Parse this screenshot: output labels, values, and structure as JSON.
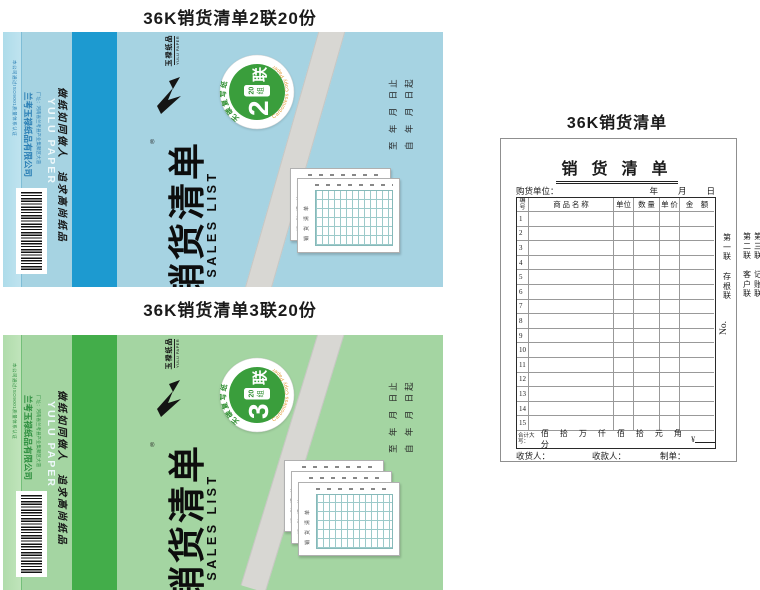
{
  "captions": {
    "blue": "36K销货清单2联20份",
    "green": "36K销货清单3联20份",
    "form": "36K销货清单"
  },
  "shared": {
    "title_cn": "销货清单",
    "title_en": "SALES LIST",
    "brand_cn": "玉禄纸品",
    "brand_en": "YULU PAPER",
    "company": "兰考玉禄纸品有限公司",
    "address": "厂址：河南省兰考县产业集聚区大道",
    "cert_line": "本公司通过ISO9001质量体系认证",
    "slogan": "做纸如同做人　追求高尚纸品",
    "date_from": "自 年 月 日起",
    "date_to": "至 年 月 日止",
    "registered": "®",
    "ring_cn": "无碳复写纸",
    "ring_en": "Carbonless Copy Paper",
    "badge_green": "#3a9e3c"
  },
  "covers": {
    "blue": {
      "product_code": "货号:36XH01",
      "badge": {
        "number": "2",
        "per": "20",
        "unit": "组",
        "lian": "联"
      },
      "bg": "#a6d3e2",
      "strip": "#1d9ad0",
      "mini_sheets": 2
    },
    "green": {
      "product_code": "货号:36XH02",
      "badge": {
        "number": "3",
        "per": "20",
        "unit": "组",
        "lian": "联"
      },
      "bg": "#a4d5a2",
      "strip": "#43ad4a",
      "mini_sheets": 3
    }
  },
  "form": {
    "title": "销 货 清 单",
    "buyer_label": "购货单位：",
    "date_line": "年　　月　　日",
    "columns": [
      "编号",
      "商 品 名 称",
      "单位",
      "数 量",
      "单 价",
      "金　额"
    ],
    "rows": [
      "1",
      "2",
      "3",
      "4",
      "5",
      "6",
      "7",
      "8",
      "9",
      "10",
      "11",
      "12",
      "13",
      "14",
      "15"
    ],
    "total_label": "合计大写：",
    "total_units": "佰 拾 万 仟 佰 拾 元 角 分",
    "currency": "¥",
    "footer": [
      "收货人：",
      "收款人：",
      "制单："
    ],
    "copy1": "第一联",
    "copy1_name": "存根联",
    "copy2": "第二联",
    "copy2_name": "客户联",
    "copy3": "第三联",
    "copy3_name": "记账联",
    "no_label": "No."
  }
}
